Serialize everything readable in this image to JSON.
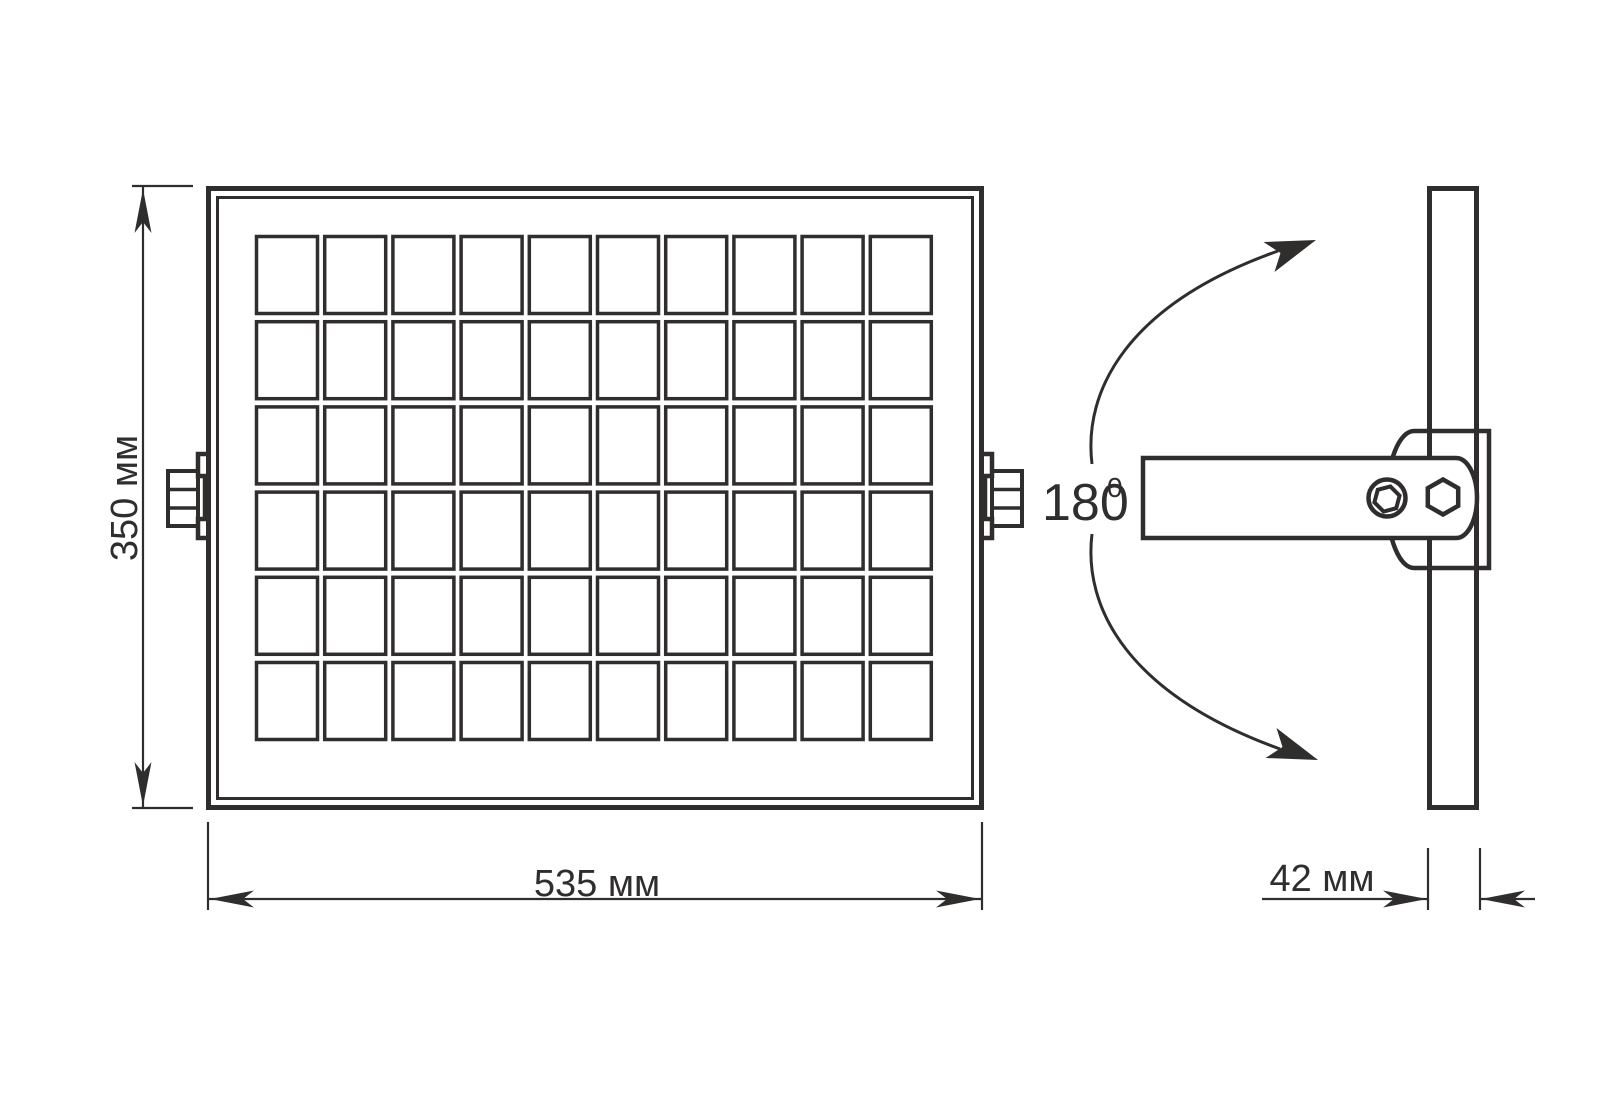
{
  "drawing": {
    "line_color": "#302d2d",
    "background_color": "#ffffff",
    "front_view": {
      "solar_grid": {
        "columns": 10,
        "rows": 6
      },
      "height_dimension": "350 мм",
      "width_dimension": "535 мм"
    },
    "side_view": {
      "rotation_angle": "180",
      "rotation_angle_superscript": "0",
      "thickness_dimension": "42 мм"
    }
  }
}
